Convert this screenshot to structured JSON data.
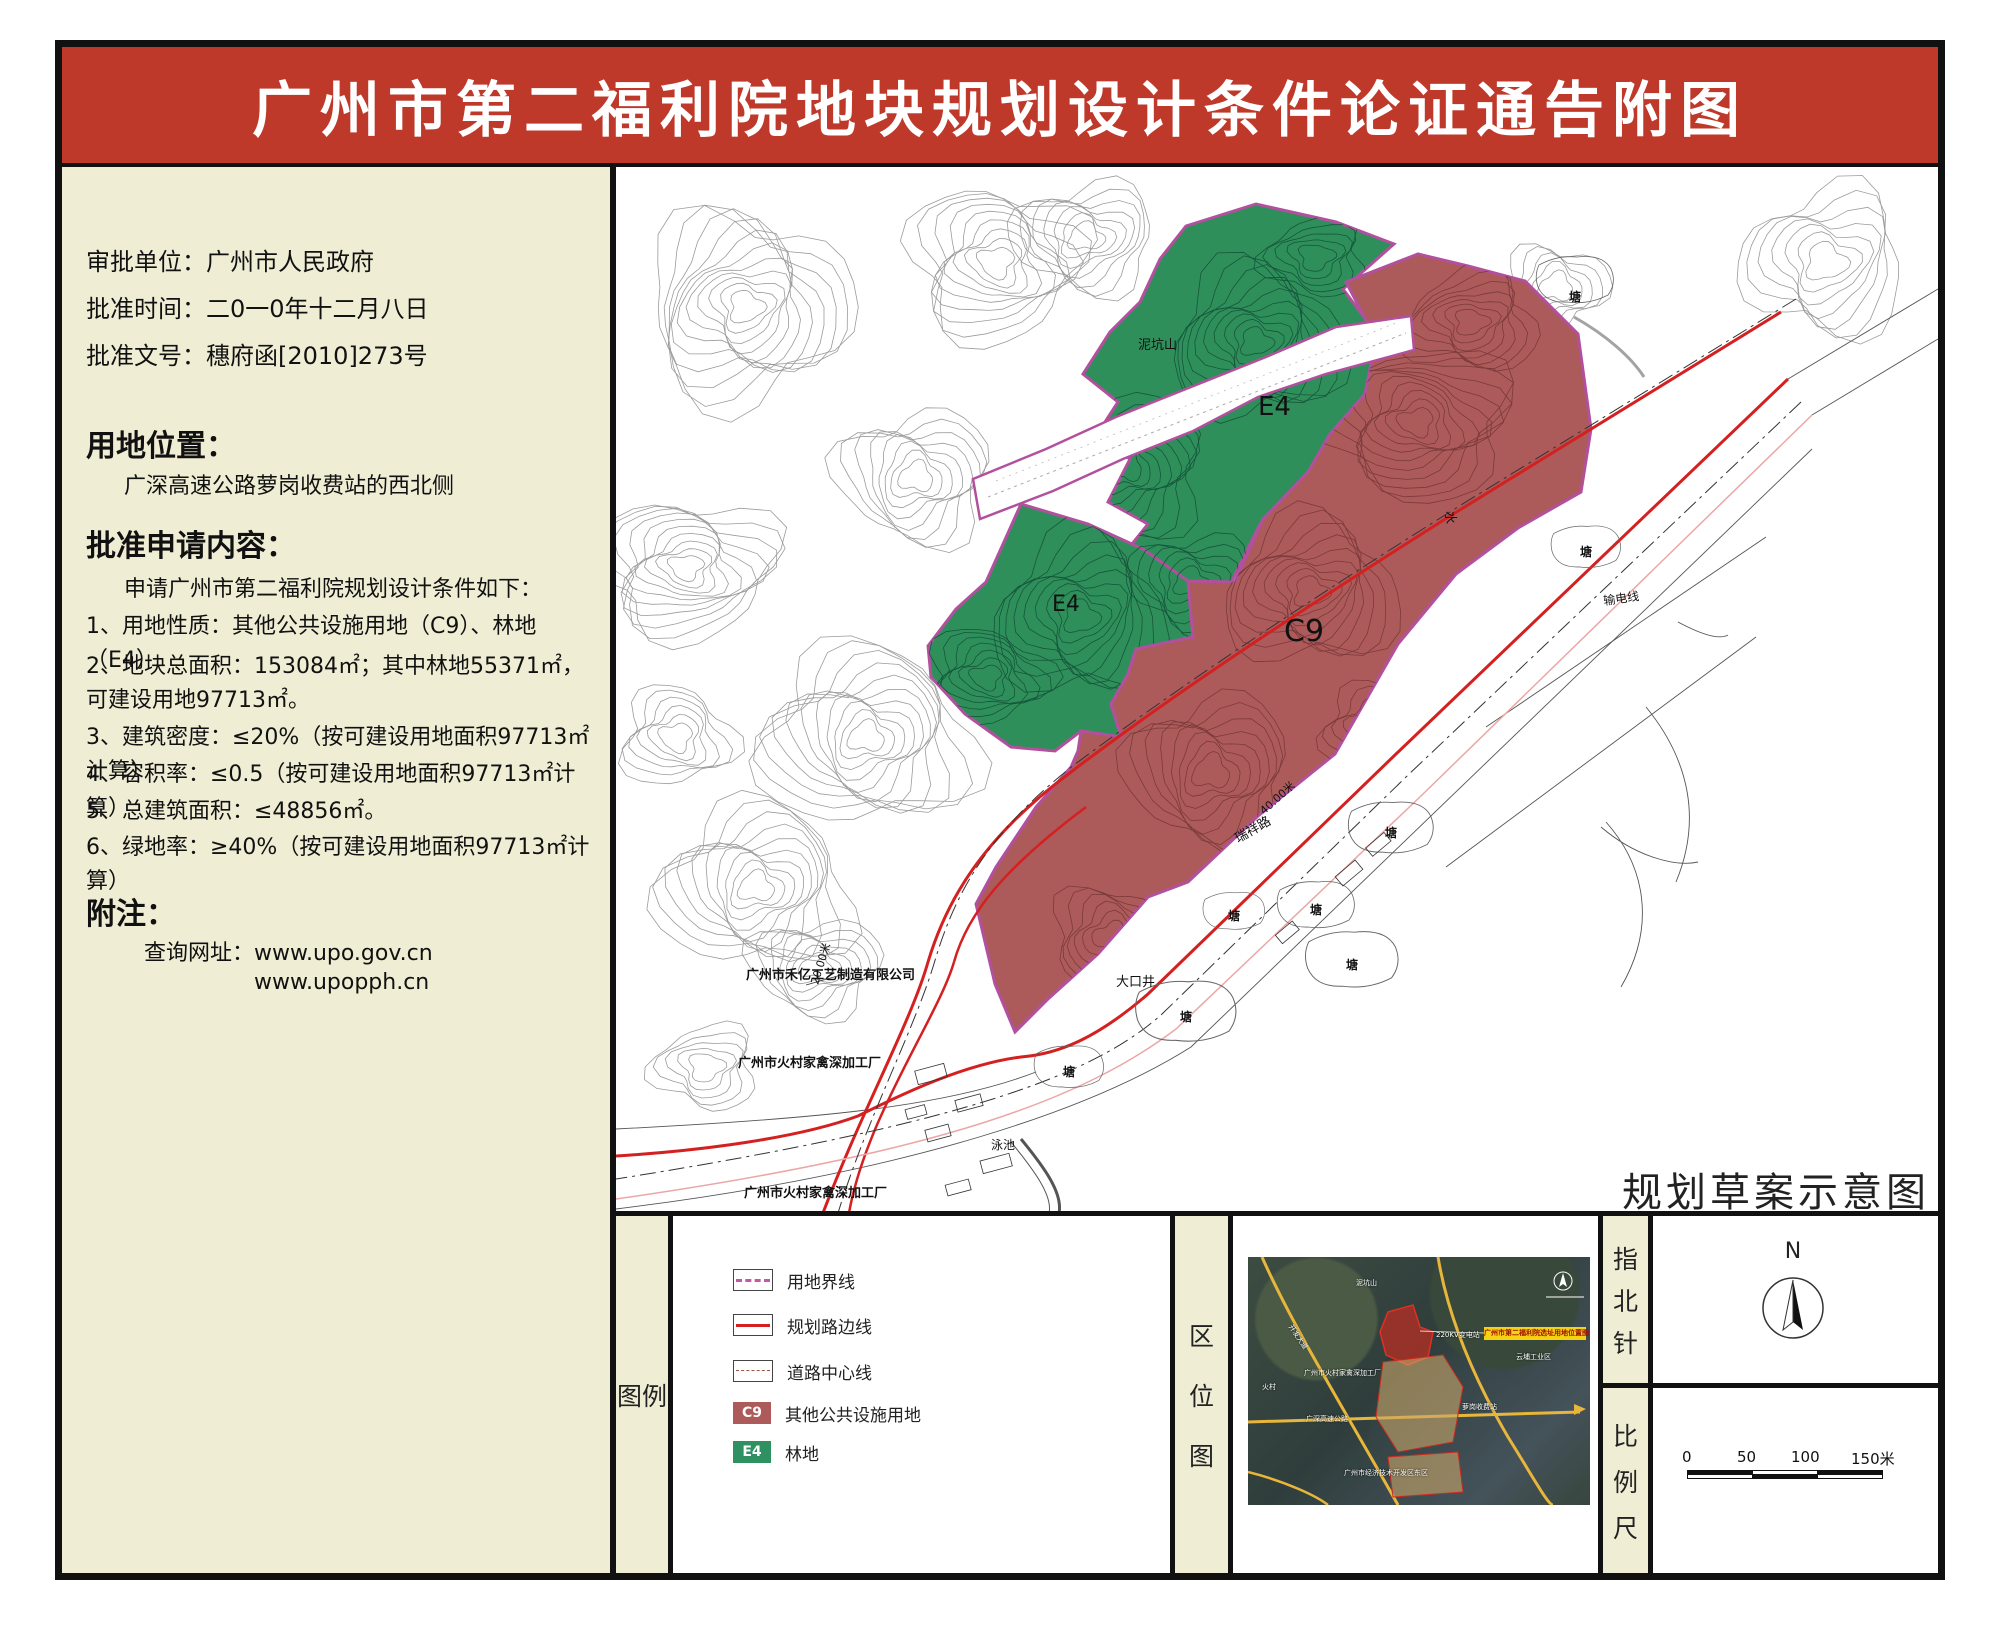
{
  "title": "广州市第二福利院地块规划设计条件论证通告附图",
  "approval": {
    "unit": "审批单位：广州市人民政府",
    "date": "批准时间：二0一0年十二月八日",
    "doc_no": "批准文号：穗府函[2010]273号"
  },
  "location": {
    "heading": "用地位置：",
    "body": "广深高速公路萝岗收费站的西北侧"
  },
  "conditions": {
    "heading": "批准申请内容：",
    "intro": "申请广州市第二福利院规划设计条件如下：",
    "items": [
      "1、用地性质：其他公共设施用地（C9）、林地（E4）",
      "2、地块总面积：153084㎡；其中林地55371㎡，可建设用地97713㎡。",
      "3、建筑密度：≤20%（按可建设用地面积97713㎡计算）",
      "4、容积率：≤0.5（按可建设用地面积97713㎡计算）",
      "5、总建筑面积：≤48856㎡。",
      "6、绿地率：≥40%（按可建设用地面积97713㎡计算）"
    ]
  },
  "notes": {
    "heading": "附注：",
    "query_line": "查询网址：www.upo.gov.cn",
    "url2": "www.upopph.cn"
  },
  "map": {
    "caption": "规划草案示意图",
    "labels": {
      "e4": "E4",
      "c9": "C9",
      "hill": "泥坑山",
      "water": "水",
      "power": "输电线",
      "road": "瑞祥路",
      "dim40": "40.00米",
      "dim20": "20.00米",
      "well": "大口井",
      "pond": "塘",
      "pool": "泳池",
      "factory_heyi": "广州市禾亿工艺制造有限公司",
      "factory_huocun": "广州市火村家禽深加工厂"
    }
  },
  "legend": {
    "title": "图例",
    "items": [
      {
        "code": "",
        "label": "用地界线"
      },
      {
        "code": "",
        "label": "规划路边线"
      },
      {
        "code": "",
        "label": "道路中心线"
      },
      {
        "code": "C9",
        "label": "其他公共设施用地"
      },
      {
        "code": "E4",
        "label": "林地"
      }
    ]
  },
  "location_map": {
    "title": "区位图",
    "chip": "广州市第二福利院选址用地位置图",
    "labels": {
      "hill": "泥坑山",
      "village": "火村",
      "substation": "220KV变电站",
      "avenue": "开发大道",
      "highway": "广深高速公路",
      "tollgate": "萝岗收费站",
      "industrial": "云埔工业区",
      "devzone": "广州市经济技术开发区东区",
      "factory": "广州市火村家禽深加工厂"
    }
  },
  "compass": {
    "title": "指北针",
    "north": "N"
  },
  "scalebar": {
    "title": "比例尺",
    "ticks": [
      "0",
      "50",
      "100",
      "150米"
    ]
  },
  "colors": {
    "banner": "#bf392b",
    "panel": "#f0edd5",
    "c9": "#ad5a5a",
    "e4": "#2f8f5b",
    "boundary": "#b2509e",
    "road_red": "#d42020"
  }
}
